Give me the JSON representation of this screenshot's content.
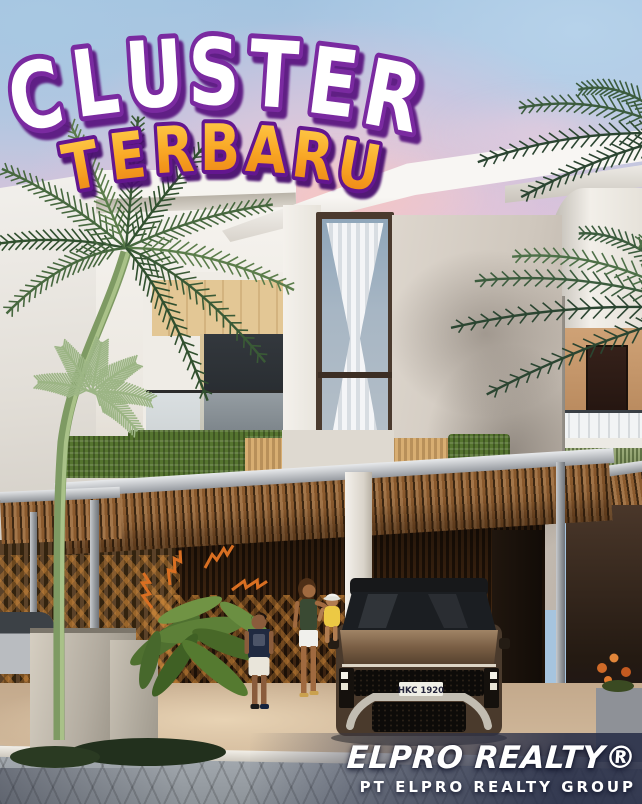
{
  "title": {
    "line1": "CLUSTER",
    "line2": "TERBARU"
  },
  "branding": {
    "company": "ELPRO REALTY®",
    "group": "PT ELPRO REALTY GROUP"
  },
  "scene": {
    "license_plate": "HKC 1920"
  },
  "colors": {
    "title_fill": "#ffffff",
    "title_outline": "#7a2ba0",
    "subtitle_outline": "#64188f",
    "subtitle_top": "#ffd14f",
    "subtitle_mid": "#f9a826",
    "subtitle_bottom": "#ea7d10",
    "sky_blue": "#a6c4de",
    "sky_pink": "#eed0d8",
    "wood": "#8a5a2e",
    "car_bronze": "#7a5f45",
    "text_white": "#ffffff"
  }
}
